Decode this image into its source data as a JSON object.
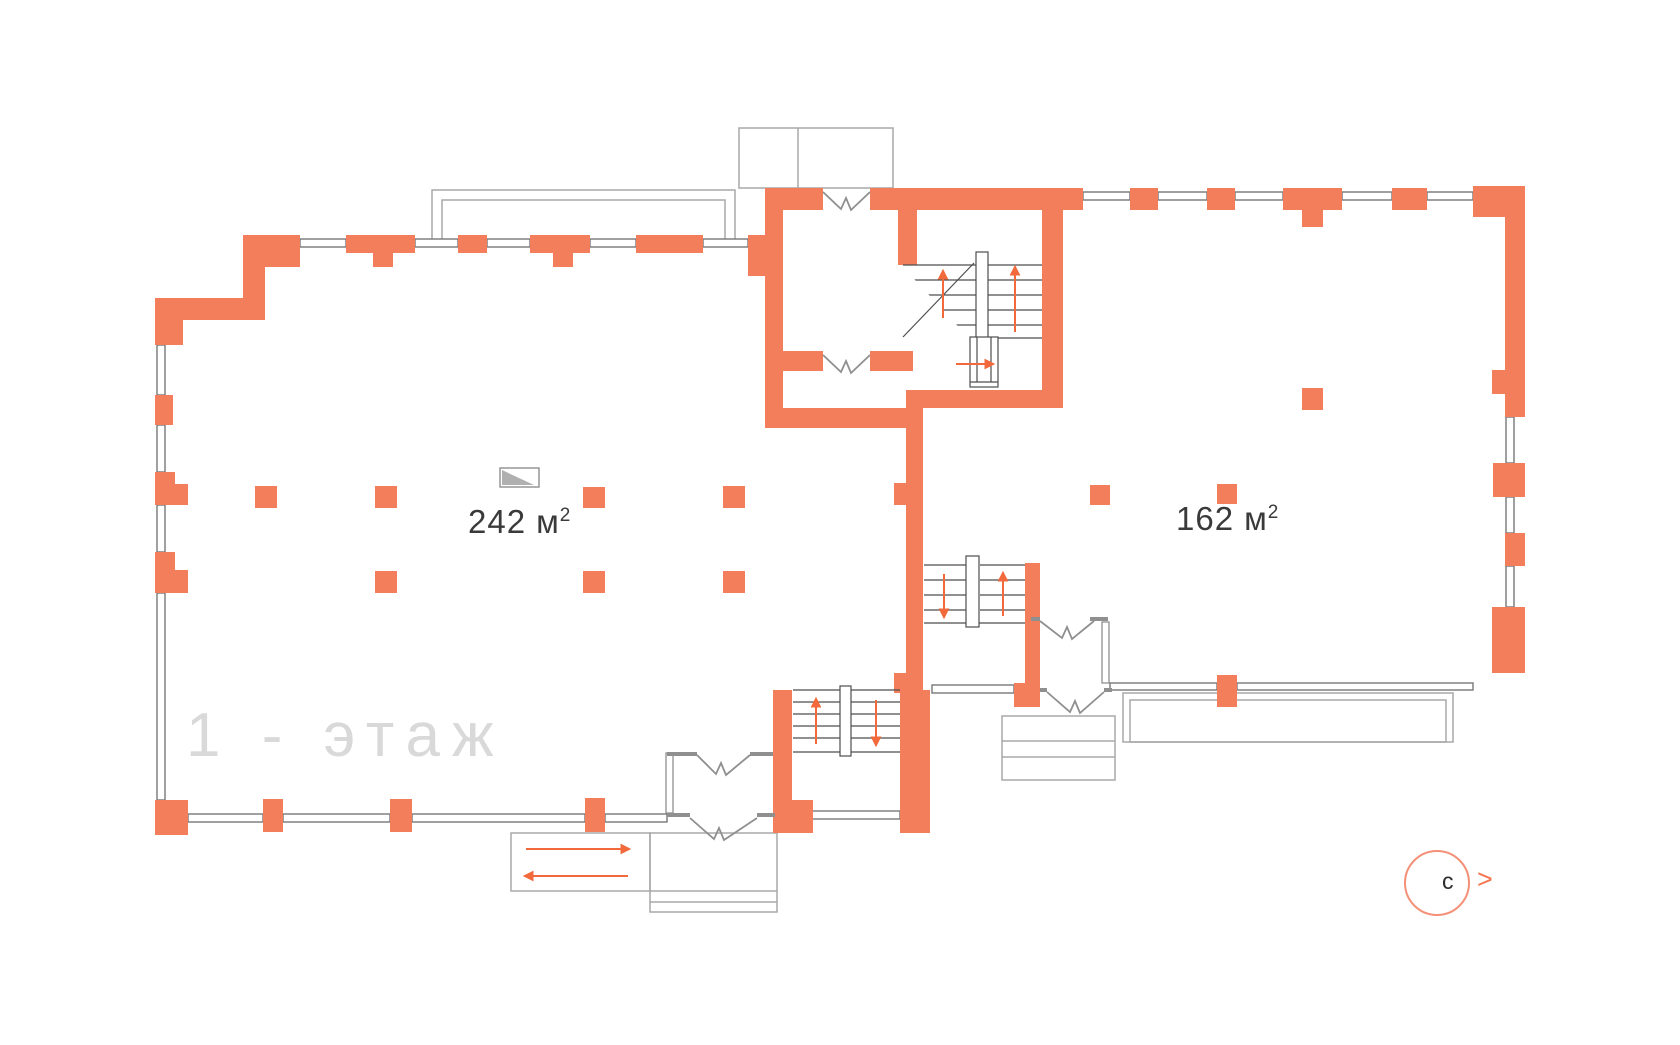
{
  "floor_plan": {
    "floor_label": "1 - этаж",
    "rooms": [
      {
        "name": "left-hall",
        "area_value": "242",
        "area_unit": "м",
        "area_sup": "2"
      },
      {
        "name": "right-hall",
        "area_value": "162",
        "area_unit": "м",
        "area_sup": "2"
      }
    ],
    "compass": {
      "north_letter": "с",
      "chevron": ">"
    },
    "icons": {
      "compass": "compass-north-indicator",
      "stairs": "staircase-symbol",
      "ramp": "ramp-arrows-symbol",
      "section_marker": "section-level-marker"
    },
    "colors": {
      "wall": "#F37E5B",
      "arrow": "#F2693C",
      "stair_line": "#4D4D4D",
      "window_line": "#787878",
      "door_line": "#8F8F8F",
      "outline": "#A8A8A8",
      "floor_label": "#D9D9D9",
      "area_text": "#3A3A3A",
      "compass_ring": "#F59078",
      "compass_chevron": "#F47650",
      "background": "#FFFFFF"
    }
  }
}
